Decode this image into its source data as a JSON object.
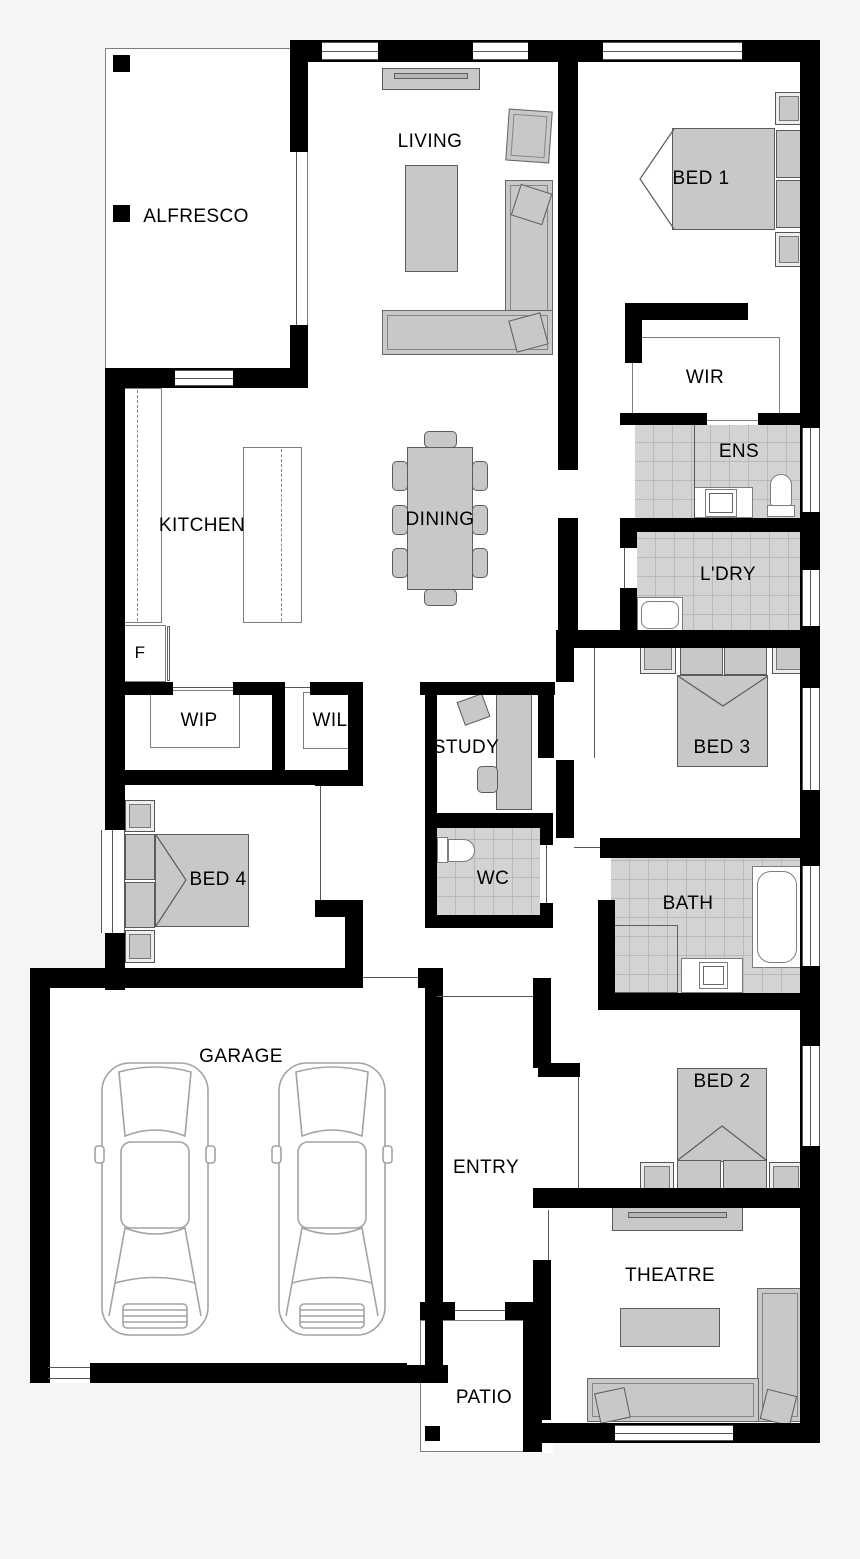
{
  "title": "House floor plan",
  "colors": {
    "background": "#f6f6f6",
    "wall": "#000000",
    "floor": "#ffffff",
    "tile": "#d3d3d3",
    "furniture": "#c8c8c8",
    "line": "#555555"
  },
  "rooms": {
    "alfresco": {
      "label": "ALFRESCO"
    },
    "living": {
      "label": "LIVING"
    },
    "bed1": {
      "label": "BED 1"
    },
    "wir": {
      "label": "WIR"
    },
    "ens": {
      "label": "ENS"
    },
    "kitchen": {
      "label": "KITCHEN"
    },
    "dining": {
      "label": "DINING"
    },
    "ldry": {
      "label": "L'DRY"
    },
    "fridge": {
      "label": "F"
    },
    "wip": {
      "label": "WIP"
    },
    "wil": {
      "label": "WIL"
    },
    "study": {
      "label": "STUDY"
    },
    "bed3": {
      "label": "BED 3"
    },
    "bed4": {
      "label": "BED 4"
    },
    "wc": {
      "label": "WC"
    },
    "bath": {
      "label": "BATH"
    },
    "garage": {
      "label": "GARAGE"
    },
    "entry": {
      "label": "ENTRY"
    },
    "bed2": {
      "label": "BED 2"
    },
    "theatre": {
      "label": "THEATRE"
    },
    "patio": {
      "label": "PATIO"
    }
  }
}
